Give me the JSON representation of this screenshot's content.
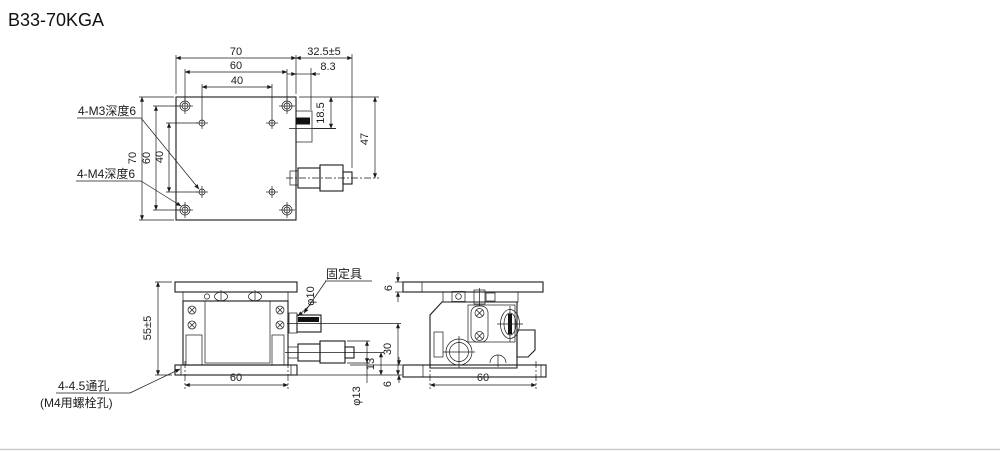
{
  "title": "B33-70KGA",
  "colors": {
    "line": "#1a1a1a",
    "fill_body": "#d8d8d8",
    "fill_plate": "#dcdcdc",
    "fill_inner": "#ececec",
    "background": "#ffffff"
  },
  "top_view": {
    "dim_width_top": "70",
    "dim_hole_span_top": "60",
    "dim_inner_span_top": "40",
    "dim_height_left": "70",
    "dim_hole_span_left": "60",
    "dim_inner_span_left": "40",
    "dim_micrometer": "32.5±5",
    "dim_clamp_offset": "8.3",
    "dim_clamp_center": "18.5",
    "dim_mic_axis": "47",
    "label_m3_holes": "4-M3深度6",
    "label_m4_holes": "4-M4深度6"
  },
  "front_view": {
    "dim_height": "55±5",
    "dim_hole_span": "60",
    "dim_knob_height": "30",
    "dim_mic_axis_height": "13",
    "dim_base_thickness": "6",
    "dim_knob_dia": "φ10",
    "dim_mic_knob_dia": "φ13",
    "label_fixture": "固定具",
    "label_through_hole": "4-4.5通孔",
    "label_bolt_hole": "(M4用螺栓孔)"
  },
  "side_view": {
    "dim_plate_thickness": "6",
    "dim_hole_span": "60"
  }
}
